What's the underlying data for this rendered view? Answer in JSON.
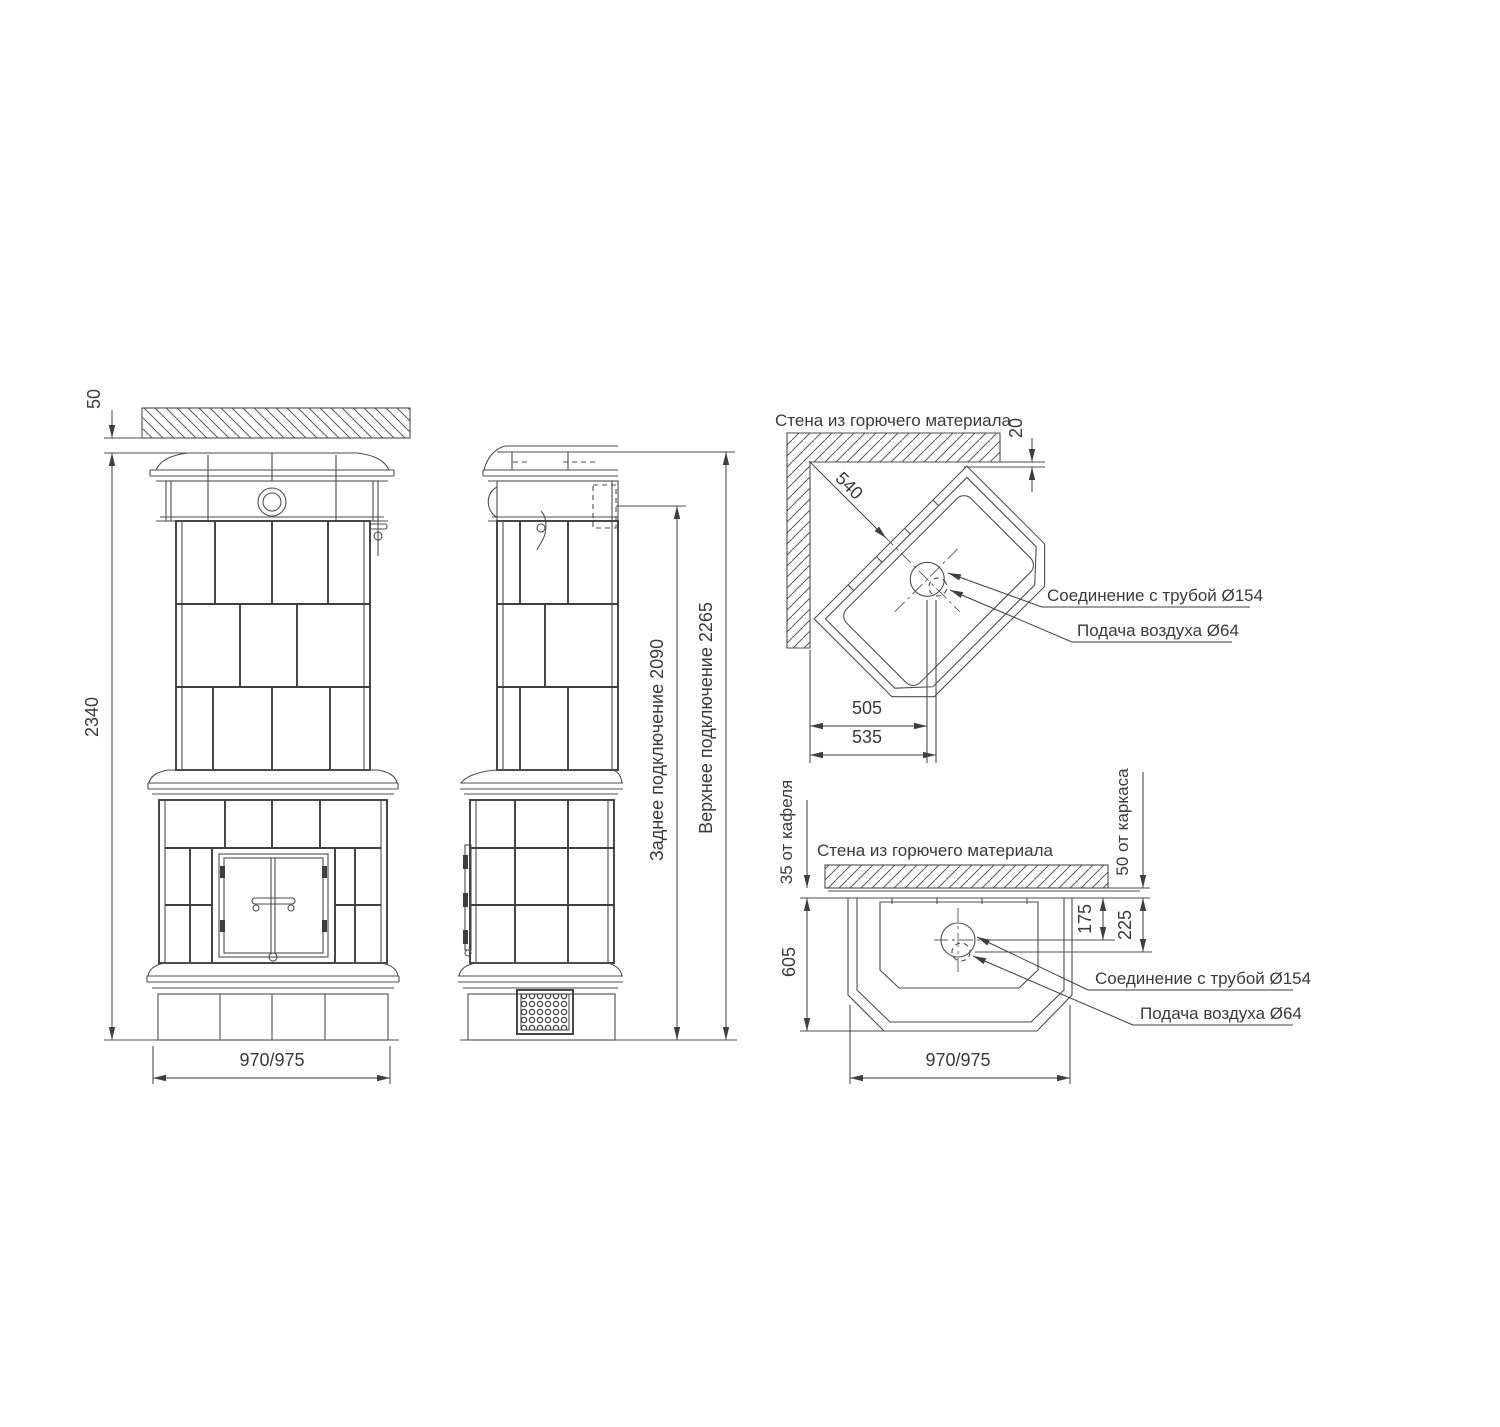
{
  "drawing": {
    "front": {
      "dim_gap_50": "50",
      "dim_height": "2340",
      "dim_width": "970/975"
    },
    "side": {
      "rear_connection": "Заднее подключение 2090",
      "top_connection": "Верхнее подключение 2265"
    },
    "corner": {
      "wall_label": "Стена из горючего материала",
      "dim_540": "540",
      "dim_20": "20",
      "dim_505": "505",
      "dim_535": "535",
      "flue_label": "Соединение с трубой Ø154",
      "air_label": "Подача воздуха Ø64"
    },
    "plan": {
      "wall_label": "Стена из горючего материала",
      "dim_35": "35 от кафеля",
      "dim_50": "50 от каркаса",
      "dim_605": "605",
      "dim_175": "175",
      "dim_225": "225",
      "dim_width": "970/975",
      "flue_label": "Соединение с трубой Ø154",
      "air_label": "Подача воздуха Ø64"
    }
  }
}
